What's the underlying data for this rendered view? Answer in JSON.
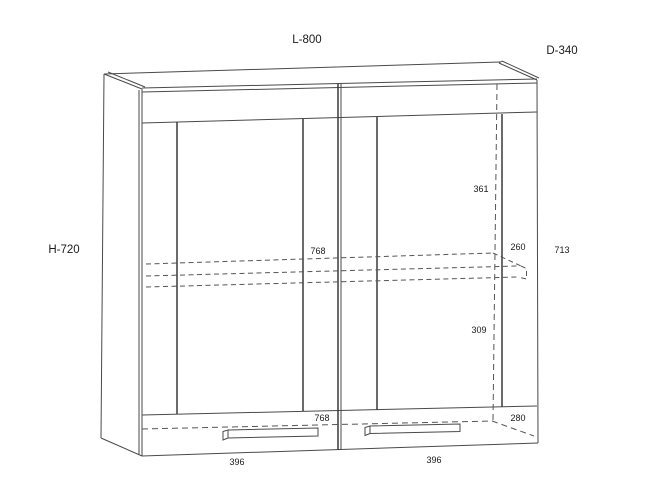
{
  "drawing": {
    "type": "cabinet-technical-drawing",
    "labels": {
      "width": "L-800",
      "depth": "D-340",
      "height": "H-720"
    },
    "dims": {
      "top_to_shelf": "361",
      "shelf_width": "768",
      "shelf_right_depth": "260",
      "interior_height": "713",
      "shelf_to_bottom": "309",
      "bottom_width": "768",
      "bottom_depth": "280",
      "door_left_width": "396",
      "door_right_width": "396"
    },
    "colors": {
      "line": "#4a4a4a",
      "hidden_line": "#555555",
      "text": "#1a1a1a",
      "background": "#ffffff"
    }
  }
}
